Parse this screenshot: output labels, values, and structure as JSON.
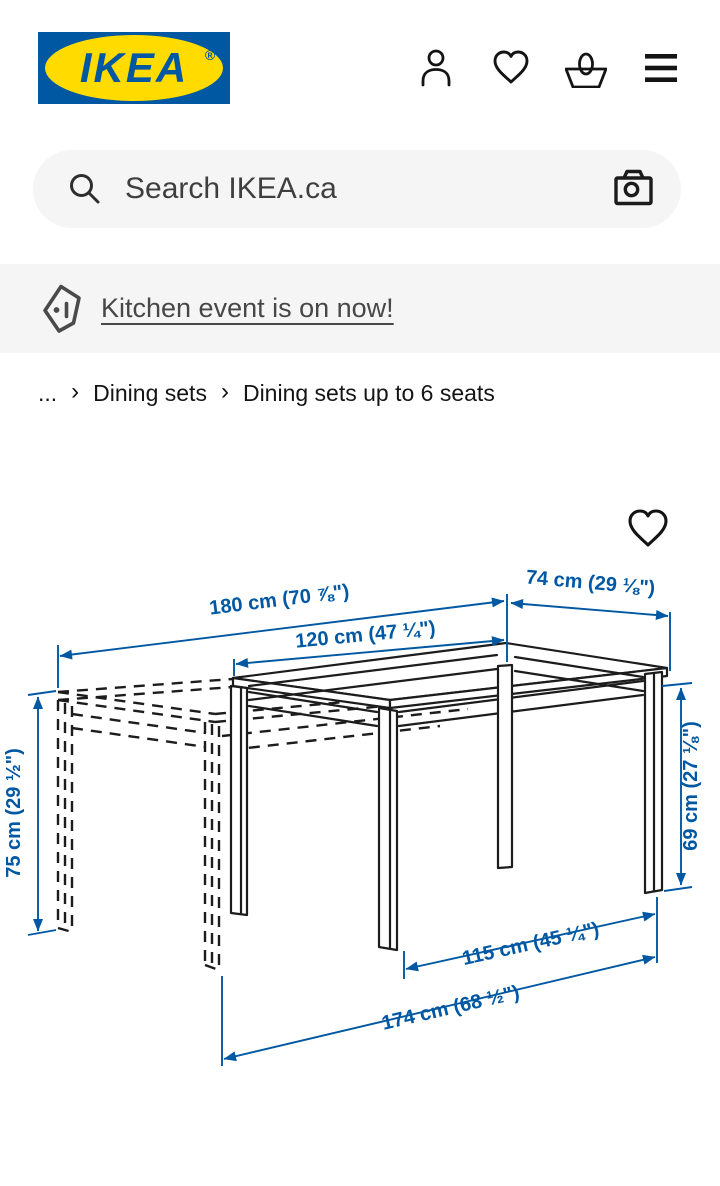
{
  "header": {
    "logo": {
      "brand": "IKEA",
      "registered": "®"
    },
    "icons": {
      "profile": "profile-icon",
      "wishlist": "heart-icon",
      "cart": "basket-icon",
      "menu": "hamburger-icon"
    }
  },
  "search": {
    "placeholder": "Search IKEA.ca",
    "icons": {
      "magnifier": "search-icon",
      "camera": "camera-search-icon"
    }
  },
  "promo_banner": {
    "icon": "price-tag-icon",
    "link_label": "Kitchen event is on now!"
  },
  "breadcrumb": {
    "ellipsis": "...",
    "separator": "›",
    "items": [
      "Dining sets",
      "Dining sets up to 6 seats"
    ]
  },
  "figure": {
    "description": "extendable dining table dimension drawing",
    "favorite_icon": "heart-icon",
    "dimensions": {
      "extended_length": "180 cm (70 ⅞\")",
      "length": "120 cm (47 ¼\")",
      "width": "74 cm (29 ⅛\")",
      "height": "75 cm (29 ½\")",
      "underframe_height": "69 cm (27 ⅛\")",
      "leg_span": "115 cm (45 ¼\")",
      "extended_leg_span": "174 cm (68 ½\")"
    }
  },
  "colors": {
    "brand_blue": "#0058A3",
    "brand_yellow": "#FFDB00",
    "dimension_blue": "#0058A3",
    "surface_gray": "#F5F5F5",
    "ink": "#1C1C1C"
  }
}
